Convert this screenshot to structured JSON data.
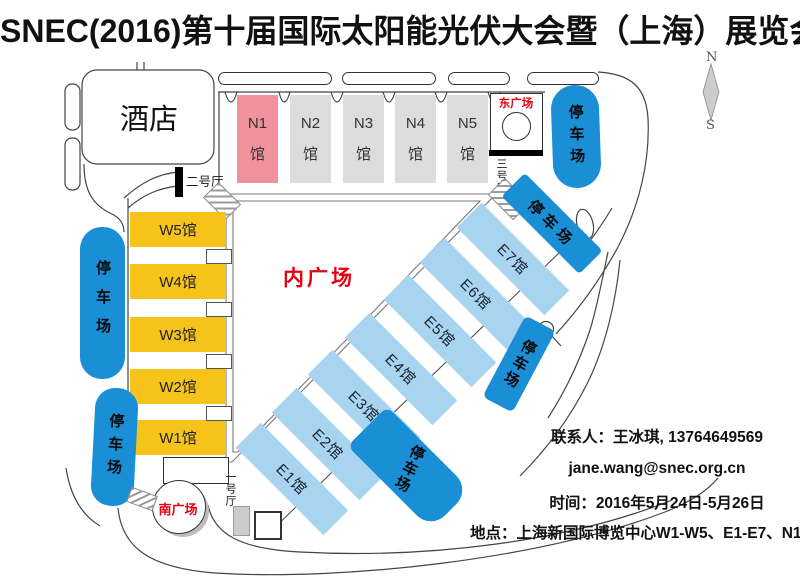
{
  "title": "SNEC(2016)第十届国际太阳能光伏大会暨（上海）展览会展馆布置图",
  "plazas": {
    "inner": "内广场",
    "east": "东广场",
    "south": "南广场"
  },
  "venues": {
    "hotel": "酒店",
    "hall1": "一号厅",
    "hall2": "二号厅",
    "hall3": "三号厅"
  },
  "labels": {
    "parking": "停车场"
  },
  "compass": {
    "north": "N",
    "south": "S"
  },
  "halls": {
    "n": [
      {
        "line1": "N1",
        "line2": "馆"
      },
      {
        "line1": "N2",
        "line2": "馆"
      },
      {
        "line1": "N3",
        "line2": "馆"
      },
      {
        "line1": "N4",
        "line2": "馆"
      },
      {
        "line1": "N5",
        "line2": "馆"
      }
    ],
    "w": [
      "W1馆",
      "W2馆",
      "W3馆",
      "W4馆",
      "W5馆"
    ],
    "e": [
      "E1馆",
      "E2馆",
      "E3馆",
      "E4馆",
      "E5馆",
      "E6馆",
      "E7馆"
    ]
  },
  "contact": {
    "person_line": "联系人：王冰琪, 13764649569",
    "email": "jane.wang@snec.org.cn",
    "date_line": "时间：2016年5月24日-5月26日",
    "venue_line": "地点：上海新国际博览中心W1-W5、E1-E7、N1馆"
  },
  "colors": {
    "n1_pink": "#F0929C",
    "hall_gray": "#DCDCDC",
    "w_yellow": "#F5C31A",
    "e_blue": "#A8D4F0",
    "parking_blue": "#1B8FD6",
    "accent_red": "#E60012"
  }
}
